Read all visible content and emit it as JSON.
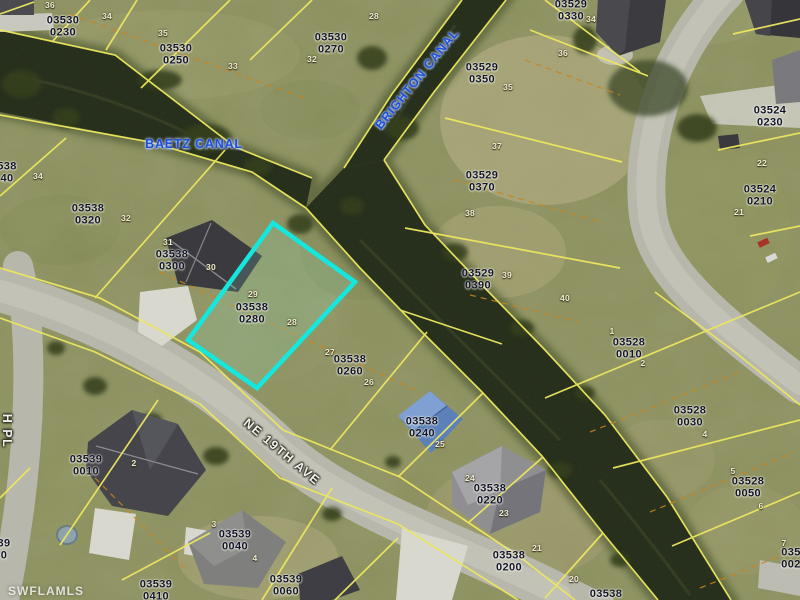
{
  "map": {
    "watermark": "SWFLAMLS",
    "colors": {
      "highlight": "#14e8de",
      "parcel_line": "#ece75f",
      "lot_line_dashed": "#c8851c",
      "water": "#222a18",
      "road": "#b7b7ac",
      "canal_text": "#1e4fd8"
    },
    "highlighted_parcel": {
      "id": "03538 0280",
      "points": "273,223 355,282 257,388 188,340"
    },
    "canal_labels": [
      {
        "text": "BAETZ CANAL",
        "x": 194,
        "y": 144,
        "rotate": 0
      },
      {
        "text": "BRIGHTON CANAL",
        "x": 417,
        "y": 79,
        "rotate": -51
      }
    ],
    "street_labels": [
      {
        "text": "NE 19TH AVE",
        "x": 282,
        "y": 452,
        "rotate": 40
      },
      {
        "text": "H PL",
        "x": 7,
        "y": 431,
        "rotate": 90
      }
    ],
    "parcel_labels": [
      {
        "line1": "03530",
        "line2": "0230",
        "x": 63,
        "y": 27
      },
      {
        "line1": "03530",
        "line2": "0250",
        "x": 176,
        "y": 55
      },
      {
        "line1": "03530",
        "line2": "0270",
        "x": 331,
        "y": 44
      },
      {
        "line1": "03529",
        "line2": "0330",
        "x": 571,
        "y": 11
      },
      {
        "line1": "03529",
        "line2": "0350",
        "x": 482,
        "y": 74
      },
      {
        "line1": "03529",
        "line2": "0370",
        "x": 482,
        "y": 182
      },
      {
        "line1": "03529",
        "line2": "0390",
        "x": 478,
        "y": 280
      },
      {
        "line1": "03524",
        "line2": "0230",
        "x": 770,
        "y": 117
      },
      {
        "line1": "03524",
        "line2": "0210",
        "x": 760,
        "y": 196
      },
      {
        "line1": "03528",
        "line2": "0010",
        "x": 629,
        "y": 349
      },
      {
        "line1": "03528",
        "line2": "0030",
        "x": 690,
        "y": 417
      },
      {
        "line1": "03528",
        "line2": "0050",
        "x": 748,
        "y": 488
      },
      {
        "line1": "03538",
        "line2": "0320",
        "x": 88,
        "y": 215
      },
      {
        "line1": "03538",
        "line2": "0300",
        "x": 172,
        "y": 261
      },
      {
        "line1": "03538",
        "line2": "0280",
        "x": 252,
        "y": 314
      },
      {
        "line1": "03538",
        "line2": "0260",
        "x": 350,
        "y": 366
      },
      {
        "line1": "03538",
        "line2": "0240",
        "x": 422,
        "y": 428
      },
      {
        "line1": "03538",
        "line2": "0220",
        "x": 490,
        "y": 495
      },
      {
        "line1": "03538",
        "line2": "0200",
        "x": 509,
        "y": 562
      },
      {
        "line1": "03539",
        "line2": "0010",
        "x": 86,
        "y": 466
      },
      {
        "line1": "03539",
        "line2": "0040",
        "x": 235,
        "y": 541
      },
      {
        "line1": "03539",
        "line2": "0410",
        "x": 156,
        "y": 591
      },
      {
        "line1": "03539",
        "line2": "0060",
        "x": 286,
        "y": 586
      },
      {
        "line1": "03538",
        "line2": "",
        "x": 606,
        "y": 594
      },
      {
        "line1": "538",
        "line2": "40",
        "x": 7,
        "y": 173
      },
      {
        "line1": "39",
        "line2": "0",
        "x": 4,
        "y": 550
      },
      {
        "line1": "035",
        "line2": "002",
        "x": 791,
        "y": 559
      }
    ],
    "lot_numbers": [
      {
        "text": "36",
        "x": 50,
        "y": 5
      },
      {
        "text": "34",
        "x": 107,
        "y": 16
      },
      {
        "text": "35",
        "x": 163,
        "y": 33
      },
      {
        "text": "33",
        "x": 233,
        "y": 66
      },
      {
        "text": "32",
        "x": 312,
        "y": 59
      },
      {
        "text": "28",
        "x": 374,
        "y": 16
      },
      {
        "text": "34",
        "x": 591,
        "y": 19
      },
      {
        "text": "36",
        "x": 563,
        "y": 53
      },
      {
        "text": "35",
        "x": 508,
        "y": 87
      },
      {
        "text": "37",
        "x": 497,
        "y": 146
      },
      {
        "text": "38",
        "x": 470,
        "y": 213
      },
      {
        "text": "39",
        "x": 507,
        "y": 275
      },
      {
        "text": "40",
        "x": 565,
        "y": 298
      },
      {
        "text": "22",
        "x": 762,
        "y": 163
      },
      {
        "text": "21",
        "x": 739,
        "y": 212
      },
      {
        "text": "34",
        "x": 38,
        "y": 176
      },
      {
        "text": "32",
        "x": 126,
        "y": 218
      },
      {
        "text": "31",
        "x": 168,
        "y": 242
      },
      {
        "text": "30",
        "x": 211,
        "y": 267
      },
      {
        "text": "29",
        "x": 253,
        "y": 294
      },
      {
        "text": "28",
        "x": 292,
        "y": 322
      },
      {
        "text": "27",
        "x": 330,
        "y": 352
      },
      {
        "text": "26",
        "x": 369,
        "y": 382
      },
      {
        "text": "25",
        "x": 440,
        "y": 444
      },
      {
        "text": "24",
        "x": 470,
        "y": 478
      },
      {
        "text": "23",
        "x": 504,
        "y": 513
      },
      {
        "text": "21",
        "x": 537,
        "y": 548
      },
      {
        "text": "20",
        "x": 574,
        "y": 579
      },
      {
        "text": "1",
        "x": 612,
        "y": 331
      },
      {
        "text": "2",
        "x": 643,
        "y": 363
      },
      {
        "text": "4",
        "x": 705,
        "y": 434
      },
      {
        "text": "5",
        "x": 733,
        "y": 471
      },
      {
        "text": "6",
        "x": 761,
        "y": 506
      },
      {
        "text": "7",
        "x": 784,
        "y": 543
      },
      {
        "text": "2",
        "x": 134,
        "y": 463
      },
      {
        "text": "3",
        "x": 214,
        "y": 524
      },
      {
        "text": "4",
        "x": 255,
        "y": 558
      }
    ]
  }
}
